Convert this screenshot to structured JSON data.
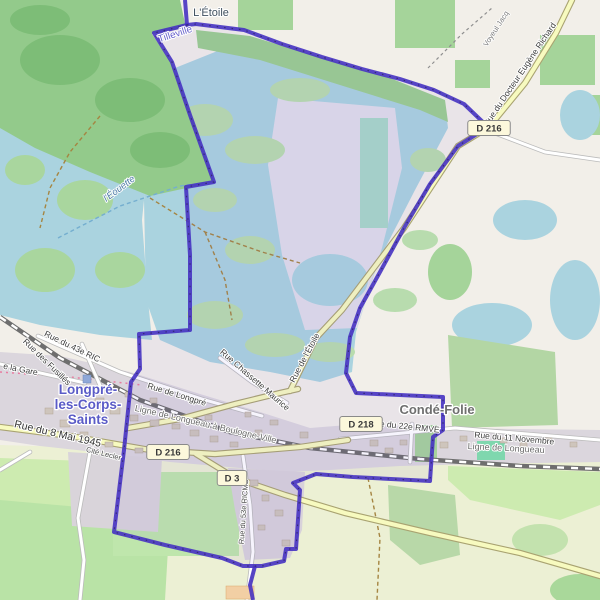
{
  "map": {
    "colors": {
      "boundary": "#4632c2",
      "water": "#aad3df",
      "forest": "#93ca8b",
      "grass": "#cdebb0",
      "residential": "#dbd6dd",
      "farmland": "#ecf0d4",
      "road_yellow": "#f7fabf",
      "railway": "#777777",
      "badge_fill": "#fcf8dc",
      "town_label": "#5a5bc7"
    },
    "labels": [
      {
        "name": "place-letoile",
        "text": "L'Étoile",
        "x": 211,
        "y": 16,
        "rot": 0,
        "cls": "hamlet"
      },
      {
        "name": "place-tilleville",
        "text": "Tilleville",
        "x": 176,
        "y": 37,
        "rot": -18,
        "cls": "locality"
      },
      {
        "name": "path-voyeul-jacq",
        "text": "Voyeul Jacq",
        "x": 498,
        "y": 30,
        "rot": -57,
        "cls": "path"
      },
      {
        "name": "road-docteur-eugene-richard",
        "text": "Rue du Docteur Eugène Richard",
        "x": 522,
        "y": 76,
        "rot": -56,
        "cls": "road"
      },
      {
        "name": "water-eouette",
        "text": "l'Éouette",
        "x": 121,
        "y": 191,
        "rot": -37,
        "cls": "water"
      },
      {
        "name": "town-longpre-line1",
        "text": "Longpré-",
        "x": 88,
        "y": 394,
        "rot": 0,
        "cls": "town"
      },
      {
        "name": "town-longpre-line2",
        "text": "les-Corps-",
        "x": 88,
        "y": 409,
        "rot": 0,
        "cls": "town"
      },
      {
        "name": "town-longpre-line3",
        "text": "Saints",
        "x": 88,
        "y": 424,
        "rot": 0,
        "cls": "town"
      },
      {
        "name": "town-conde-folie",
        "text": "Condé-Folie",
        "x": 437,
        "y": 414,
        "rot": 0,
        "cls": "town-gray"
      },
      {
        "name": "road-43e-ric",
        "text": "Rue du 43e RIC",
        "x": 71,
        "y": 349,
        "rot": 26,
        "cls": "road"
      },
      {
        "name": "road-des-fusilles",
        "text": "Rue des Fusillés",
        "x": 45,
        "y": 364,
        "rot": 44,
        "cls": "road"
      },
      {
        "name": "road-de-la-gare",
        "text": "e la Gare",
        "x": 20,
        "y": 372,
        "rot": 11,
        "cls": "road"
      },
      {
        "name": "road-8-mai-1945",
        "text": "Rue du 8 Mai 1945",
        "x": 57,
        "y": 437,
        "rot": 13,
        "cls": "road-lg"
      },
      {
        "name": "road-cite-leclerc",
        "text": "Cité Lecler",
        "x": 103,
        "y": 456,
        "rot": 14,
        "cls": "road-sm"
      },
      {
        "name": "road-de-longpre",
        "text": "Rue de Longpré",
        "x": 176,
        "y": 397,
        "rot": 17,
        "cls": "road"
      },
      {
        "name": "road-chassette-maurice",
        "text": "Rue Chassette Maurice",
        "x": 253,
        "y": 382,
        "rot": 41,
        "cls": "road"
      },
      {
        "name": "road-de-letoile",
        "text": "Rue de l'Étoile",
        "x": 307,
        "y": 359,
        "rot": -62,
        "cls": "road"
      },
      {
        "name": "railway-longueau-boulogne-ville",
        "text": "Ligne de Longueau à Boulogne-Ville",
        "x": 205,
        "y": 427,
        "rot": 13,
        "cls": "rail"
      },
      {
        "name": "railway-longueau",
        "text": "Ligne de Longueau",
        "x": 506,
        "y": 451,
        "rot": 3,
        "cls": "rail"
      },
      {
        "name": "road-22e-rmve",
        "text": "Rue du 22e RMVE",
        "x": 404,
        "y": 429,
        "rot": 6,
        "cls": "road"
      },
      {
        "name": "road-11-novembre",
        "text": "Rue du 11 Novembre",
        "x": 514,
        "y": 441,
        "rot": 5,
        "cls": "road"
      },
      {
        "name": "road-53e-ricms",
        "text": "Rue du 53e RICMS",
        "x": 246,
        "y": 512,
        "rot": -86,
        "cls": "road-sm"
      }
    ],
    "badges": [
      {
        "name": "badge-d216-north",
        "text": "D 216",
        "x": 489,
        "y": 128
      },
      {
        "name": "badge-d216-west",
        "text": "D 216",
        "x": 168,
        "y": 452
      },
      {
        "name": "badge-d3",
        "text": "D 3",
        "x": 232,
        "y": 478
      },
      {
        "name": "badge-d218",
        "text": "D 218",
        "x": 361,
        "y": 424
      }
    ]
  }
}
